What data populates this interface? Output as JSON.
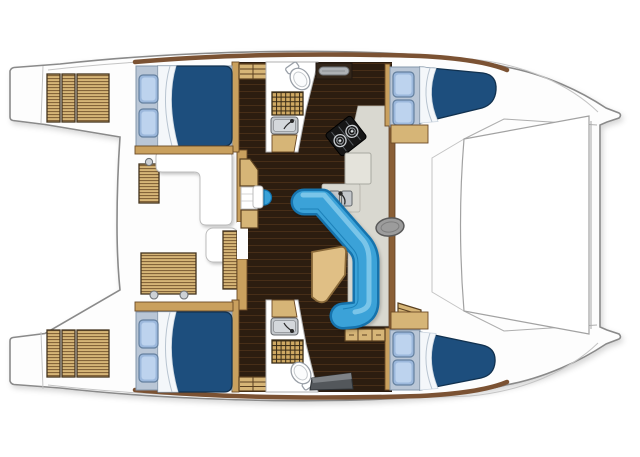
{
  "title": "Catamaran interior layout floor plan (overhead view)",
  "diagram": {
    "type": "boat-floor-plan",
    "vessel": "sailing catamaran",
    "view": "top-down deck and accommodation plan",
    "counts": {
      "cabins": 4,
      "double_berths": 4,
      "heads": 2,
      "pillows": 8,
      "transom_steps_per_side": 3
    },
    "areas": {
      "cockpit": {
        "position": "aft (left of plan)",
        "features": [
          "white lounge settee",
          "white bench seat",
          "large teak deck hatch with two handles",
          "side teak hatch",
          "vertical teak locker"
        ]
      },
      "transoms": {
        "features": [
          "port swim steps",
          "starboard swim steps"
        ]
      },
      "salon": {
        "position": "bridgedeck center",
        "features": [
          "C-shaped blue sofa",
          "wood cocktail table",
          "storage cabinet",
          "blue half-round stool",
          "entry post"
        ]
      },
      "galley": {
        "features": [
          "two-burner stove",
          "double sink with faucet",
          "counter unit",
          "drawer unit",
          "shelf with tray"
        ]
      },
      "port_hull": {
        "aft_cabin": "double berth with two pillows",
        "head": [
          "toilet",
          "vanity sink",
          "teak shower grate",
          "cabinet"
        ],
        "forward_cabin": "double berth with two pillows",
        "companionway": "steps from salon"
      },
      "starboard_hull": {
        "aft_cabin": "double berth with two pillows",
        "head": [
          "toilet",
          "vanity sink",
          "teak shower grate",
          "dark counter"
        ],
        "forward_cabin": "double berth with two pillows",
        "companionway": "steps from salon"
      },
      "foredeck": {
        "position": "bow (right of plan)",
        "features": [
          "trampoline",
          "forward crossbeam",
          "mast step oval"
        ]
      }
    }
  },
  "colors": {
    "background": "#ffffff",
    "hull_fill": "#fdfdfd",
    "hull_outline": "#8a8a8a",
    "wall_brown": "#7b5233",
    "wall_brown_dark": "#8a5f36",
    "wall_tan": "#c9a05e",
    "wood_light": "#d6b577",
    "wood_stripe": "#7a5a32",
    "grate_wood": "#cfa963",
    "grate_line": "#3a2c16",
    "floor_dark": "#2c1d10",
    "floor_plank_line": "#4a3018",
    "deck_gray": "#d9d8d0",
    "mattress_blue": "#1d4e7d",
    "bed_frame": "#b9c6d6",
    "pillow_fill": "#9cb8dc",
    "pillow_inner": "#bdd3ee",
    "sheet_white": "#f4f7fa",
    "sofa_fill": "#3aa2d8",
    "sofa_border": "#1273ad",
    "sofa_highlight": "#86cbec",
    "table_wood": "#e0bf85",
    "fixture_white": "#ffffff",
    "sink_gray": "#c4c8cc",
    "sink_inner": "#d4d8dc",
    "stove_black": "#161616",
    "mast_gray": "#9c9c9c",
    "counter_dark": "#53575b",
    "counter_dark_top": "#7e8286",
    "tray_gray": "#aeb2b6",
    "shelf_dark": "#33261a",
    "faucet_dark": "#2a2a2a"
  }
}
